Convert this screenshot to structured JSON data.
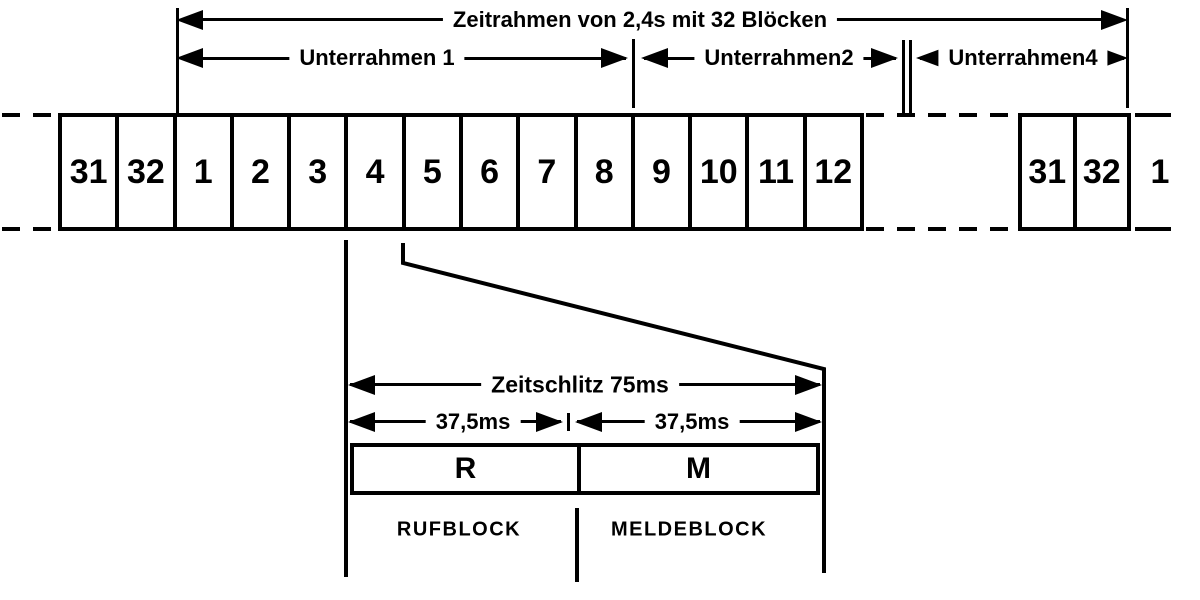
{
  "colors": {
    "ink": "#000000",
    "bg": "#ffffff"
  },
  "frame_arrow": {
    "label": "Zeitrahmen von 2,4s mit 32 Blöcken"
  },
  "subframe_arrows": {
    "sub1": "Unterrahmen 1",
    "sub2": "Unterrahmen2",
    "sub4": "Unterrahmen4"
  },
  "block_row": {
    "main": [
      "31",
      "32",
      "1",
      "2",
      "3",
      "4",
      "5",
      "6",
      "7",
      "8",
      "9",
      "10",
      "11",
      "12"
    ],
    "next_frame": [
      "31",
      "32"
    ],
    "overflow": "1"
  },
  "timeslot": {
    "title": "Zeitschlitz 75ms",
    "left_half": "37,5ms",
    "right_half": "37,5ms",
    "r": "R",
    "m": "M",
    "r_caption": "RUFBLOCK",
    "m_caption": "MELDEBLOCK"
  }
}
